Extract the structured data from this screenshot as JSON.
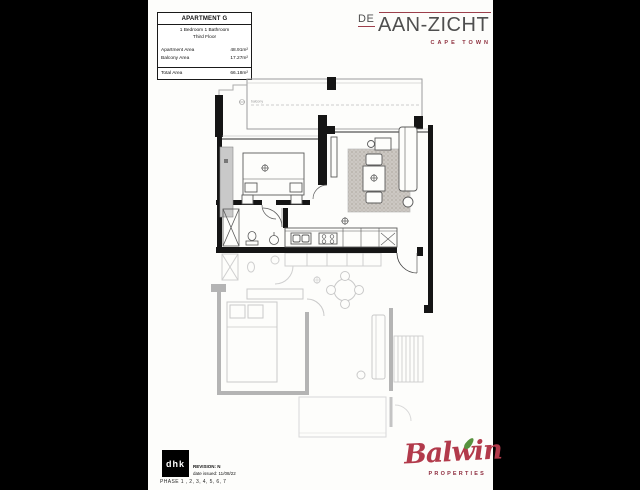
{
  "page": {
    "background_color": "#000000",
    "paper_color": "#fdfdfb"
  },
  "info_table": {
    "title": "APARTMENT G",
    "subtitle_line1": "1 Bedroom 1 Bathroom",
    "subtitle_line2": "Third Floor",
    "rows": [
      {
        "label": "Apartment Area",
        "value": "48.91m²"
      },
      {
        "label": "Balcony Area",
        "value": "17.27m²"
      }
    ],
    "total": {
      "label": "Total Area",
      "value": "66.18m²"
    }
  },
  "brand": {
    "prefix": "DE",
    "name": "AAN-ZICHT",
    "subtitle": "CAPE TOWN",
    "accent_color": "#9c3f4b",
    "text_color": "#4f4f4f"
  },
  "floor_plan": {
    "balcony_label": "balcony"
  },
  "architect": {
    "logo_text": "dhk",
    "revision": "REVISION: N",
    "date_issued": "date issued: 11/08/22"
  },
  "phase_note": "PHASE 1 , 2, 3, 4, 5, 6, 7",
  "developer": {
    "name": "Balwin",
    "subtitle": "PROPERTIES",
    "script_color": "#b23a4b",
    "leaf_color": "#57923e",
    "subtitle_color": "#8e2c3e"
  }
}
